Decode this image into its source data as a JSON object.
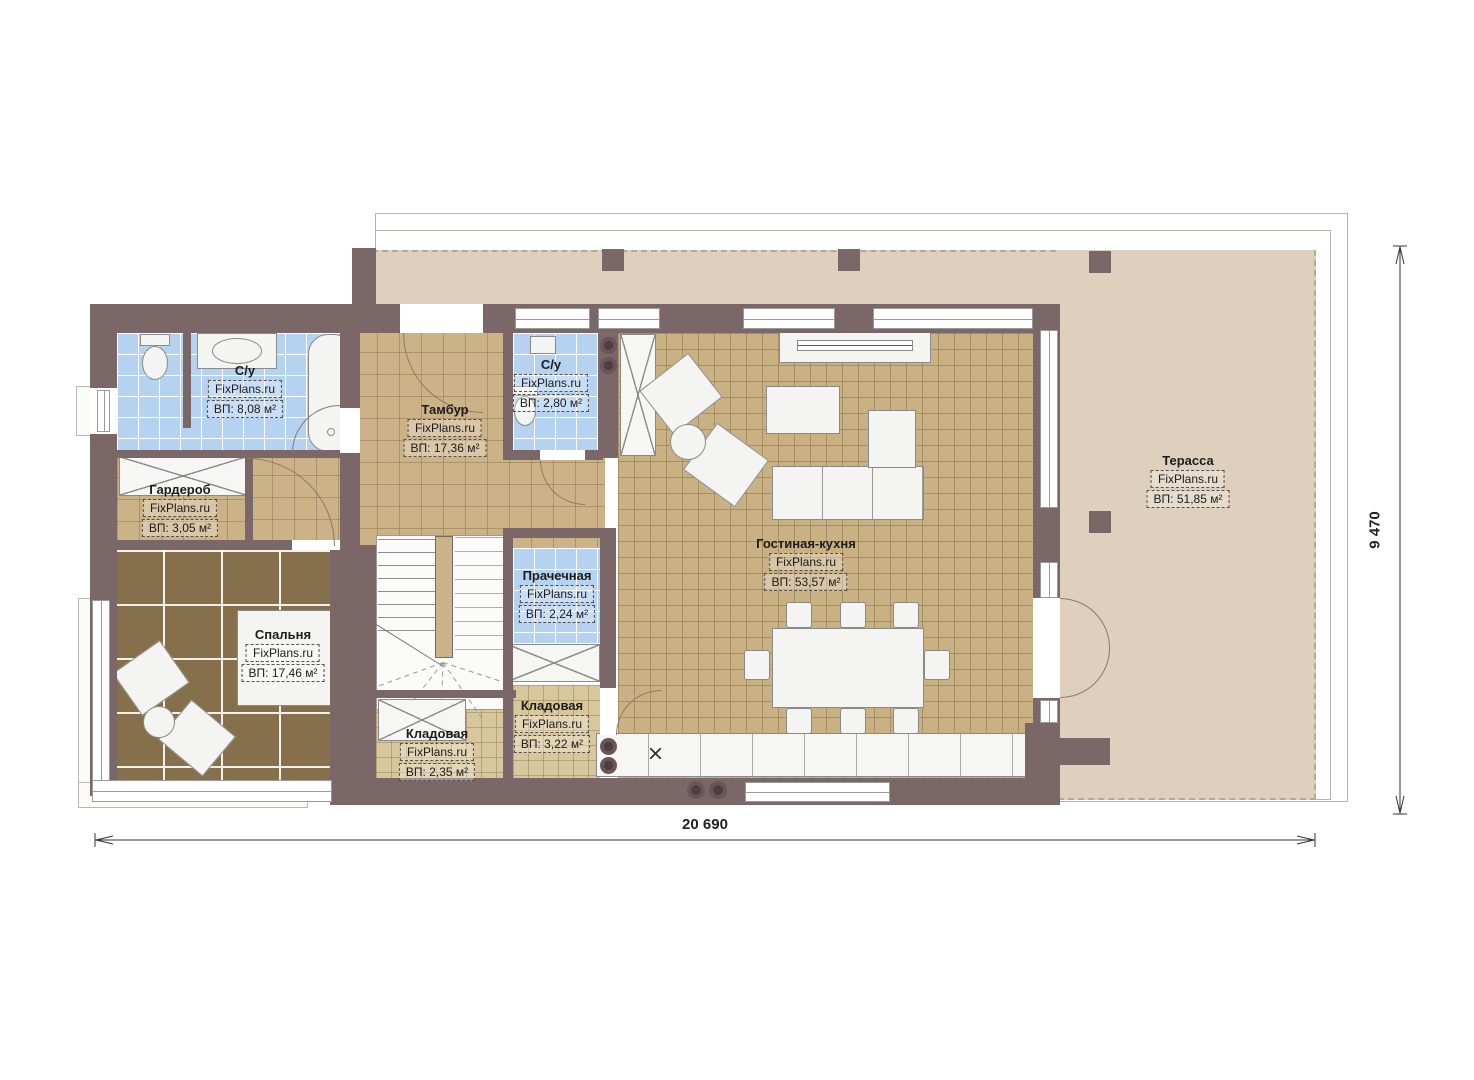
{
  "plan": {
    "watermark": "FixPlans.ru",
    "rooms": [
      {
        "name": "С/у",
        "watermark": "FixPlans.ru",
        "area": "ВП: 8,08 м²"
      },
      {
        "name": "Гардероб",
        "watermark": "FixPlans.ru",
        "area": "ВП: 3,05 м²"
      },
      {
        "name": "Тамбур",
        "watermark": "FixPlans.ru",
        "area": "ВП: 17,36 м²"
      },
      {
        "name": "С/у",
        "watermark": "FixPlans.ru",
        "area": "ВП: 2,80 м²"
      },
      {
        "name": "Спальня",
        "watermark": "FixPlans.ru",
        "area": "ВП: 17,46 м²"
      },
      {
        "name": "Прачечная",
        "watermark": "FixPlans.ru",
        "area": "ВП: 2,24 м²"
      },
      {
        "name": "Кладовая",
        "watermark": "FixPlans.ru",
        "area": "ВП: 2,35 м²"
      },
      {
        "name": "Кладовая",
        "watermark": "FixPlans.ru",
        "area": "ВП: 3,22 м²"
      },
      {
        "name": "Гостиная-кухня",
        "watermark": "FixPlans.ru",
        "area": "ВП: 53,57 м²"
      },
      {
        "name": "Терасса",
        "watermark": "FixPlans.ru",
        "area": "ВП: 51,85 м²"
      }
    ],
    "dimensions": {
      "width": "20 690",
      "height": "9 470"
    },
    "colors": {
      "wall": "#7b6767",
      "terrace": "#ded0bc",
      "hall_floor": "#ccb287",
      "living_floor": "#c9b184",
      "wet_floor": "#b5d2f0",
      "bedroom_floor": "#86704c",
      "storage_floor": "#d8c69c",
      "outline": "#b5b2ad"
    }
  }
}
